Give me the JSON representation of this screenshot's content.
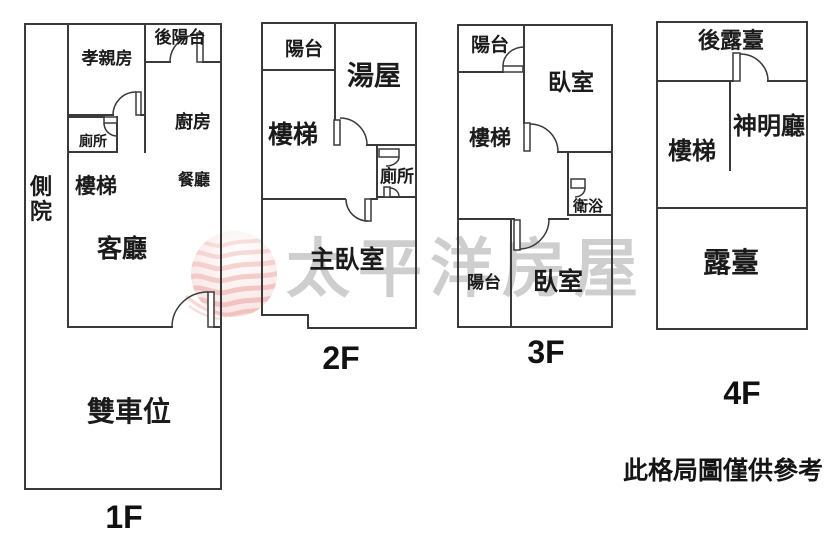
{
  "colors": {
    "wall": "#3a3a3a",
    "label_text": "#1b1b1b",
    "floor_label": "#111111",
    "watermark_text": "#c6c6c6",
    "logo_pink": "#e9a19d",
    "background": "#ffffff"
  },
  "watermark": {
    "brand_text": "太平洋房屋",
    "logo": "pacific-sphere-logo"
  },
  "note": {
    "text": "此格局圖僅供參考"
  },
  "floors": [
    {
      "label": "1F",
      "rooms": {
        "side_yard": "側院",
        "parents_room": "孝親房",
        "rear_balcony": "後陽台",
        "kitchen": "廚房",
        "toilet": "廁所",
        "stairs": "樓梯",
        "dining_room": "餐廳",
        "living_room": "客廳",
        "double_carport": "雙車位"
      }
    },
    {
      "label": "2F",
      "rooms": {
        "balcony": "陽台",
        "hot_spring_room": "湯屋",
        "stairs": "樓梯",
        "toilet": "廁所",
        "master_bedroom": "主臥室"
      }
    },
    {
      "label": "3F",
      "rooms": {
        "front_balcony": "陽台",
        "front_bedroom": "臥室",
        "stairs": "樓梯",
        "bathroom": "衛浴",
        "rear_balcony": "陽台",
        "rear_bedroom": "臥室"
      }
    },
    {
      "label": "4F",
      "rooms": {
        "rear_terrace": "後露臺",
        "stairs": "樓梯",
        "shrine_hall": "神明廳",
        "terrace": "露臺"
      }
    }
  ]
}
